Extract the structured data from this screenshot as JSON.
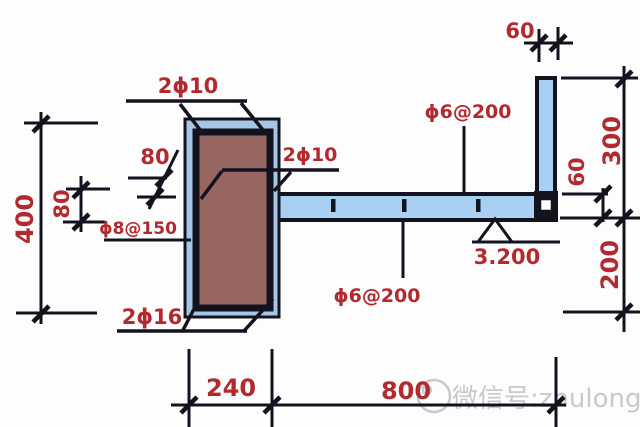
{
  "drawing": {
    "title_hint": "reinforced concrete cantilever slab and column detail section",
    "rebar_labels": {
      "column_top_bars": "2ϕ10",
      "slab_top_bars": "2ϕ10",
      "column_stirrups": "ϕ8@150",
      "column_bottom_bars": "2ϕ16",
      "slab_bars_top": "ϕ6@200",
      "slab_bars_bottom": "ϕ6@200"
    },
    "dimensions": {
      "column_height": "400",
      "left_offset": "80",
      "bar_bend": "80",
      "column_width": "240",
      "slab_span": "800",
      "parapet_width": "60",
      "parapet_height": "300",
      "slab_end_thickness": "60",
      "below_slab": "200"
    },
    "elevation_mark": "3.200",
    "watermark_text": "微信号:zhulongjg",
    "colors": {
      "line": "#131320",
      "column_band": "#a6c6e6",
      "column_fill": "#976660",
      "slab_fill": "#a9d0f2",
      "label_red": "#b2292e",
      "watermark_gray": "#c9c9c9",
      "background": "#fdfdfd"
    }
  }
}
